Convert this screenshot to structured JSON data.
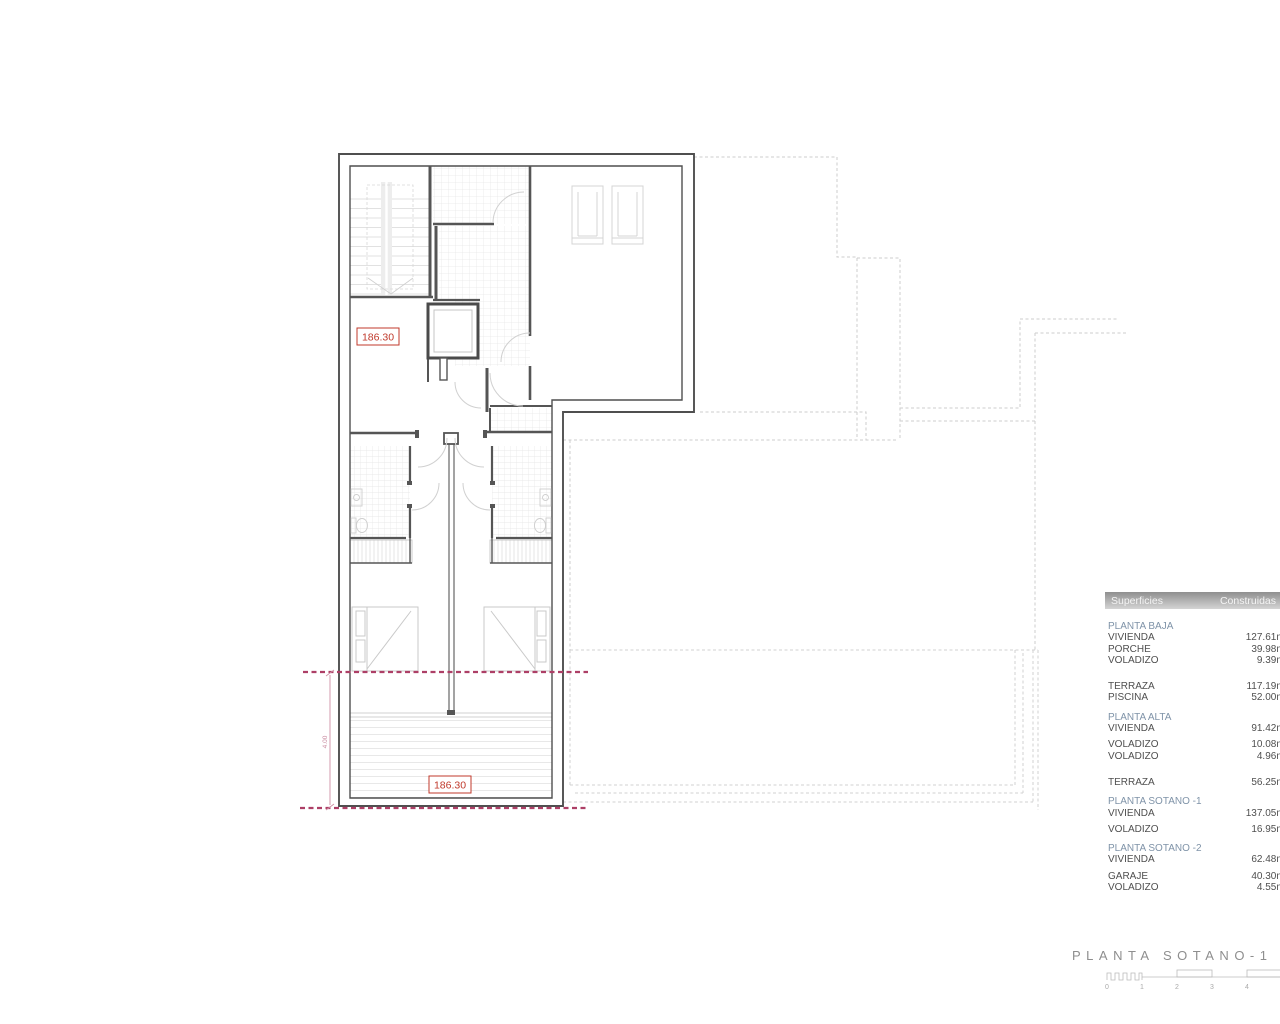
{
  "drawing": {
    "area_label_top": "186.30",
    "area_label_bottom": "186.30",
    "dimension_label": "4.00"
  },
  "legend_table": {
    "header": {
      "col_left": "Superficies",
      "col_right": "Construidas"
    },
    "rows": [
      {
        "type": "section",
        "label": "PLANTA BAJA",
        "value": ""
      },
      {
        "type": "item",
        "label": "VIVIENDA",
        "value": "127.61m²"
      },
      {
        "type": "item",
        "label": "PORCHE",
        "value": "39.98m²"
      },
      {
        "type": "item",
        "label": "VOLADIZO",
        "value": "9.39m²"
      },
      {
        "type": "spacer",
        "label": "",
        "value": ""
      },
      {
        "type": "item",
        "label": "TERRAZA",
        "value": "117.19m²"
      },
      {
        "type": "item",
        "label": "PISCINA",
        "value": "52.00m²"
      },
      {
        "type": "section",
        "label": "PLANTA ALTA",
        "value": ""
      },
      {
        "type": "item",
        "label": "VIVIENDA",
        "value": "91.42m²"
      },
      {
        "type": "item_gap",
        "label": "VOLADIZO",
        "value": "10.08m²"
      },
      {
        "type": "item",
        "label": "VOLADIZO",
        "value": "4.96m²"
      },
      {
        "type": "spacer",
        "label": "",
        "value": ""
      },
      {
        "type": "item",
        "label": "TERRAZA",
        "value": "56.25m²"
      },
      {
        "type": "section",
        "label": "PLANTA SOTANO -1",
        "value": ""
      },
      {
        "type": "item",
        "label": "VIVIENDA",
        "value": "137.05m²"
      },
      {
        "type": "item_gap",
        "label": "VOLADIZO",
        "value": "16.95m²"
      },
      {
        "type": "section",
        "label": "PLANTA SOTANO -2",
        "value": ""
      },
      {
        "type": "item",
        "label": "VIVIENDA",
        "value": "62.48m²"
      },
      {
        "type": "item_gap",
        "label": "GARAJE",
        "value": "40.30m²"
      },
      {
        "type": "item",
        "label": "VOLADIZO",
        "value": "4.55m²"
      }
    ]
  },
  "title_block": {
    "title": "PLANTA SOTANO-1"
  },
  "scale_bar": {
    "labels": [
      "0",
      "1",
      "2",
      "3",
      "4",
      "5"
    ]
  },
  "colors": {
    "wall": "#4f4f4f",
    "section_line_magenta": "#ad3f66",
    "area_label_red": "#c0392b",
    "dimension_pink": "#cf8fa5",
    "section_heading_blue": "#7f93a8"
  }
}
